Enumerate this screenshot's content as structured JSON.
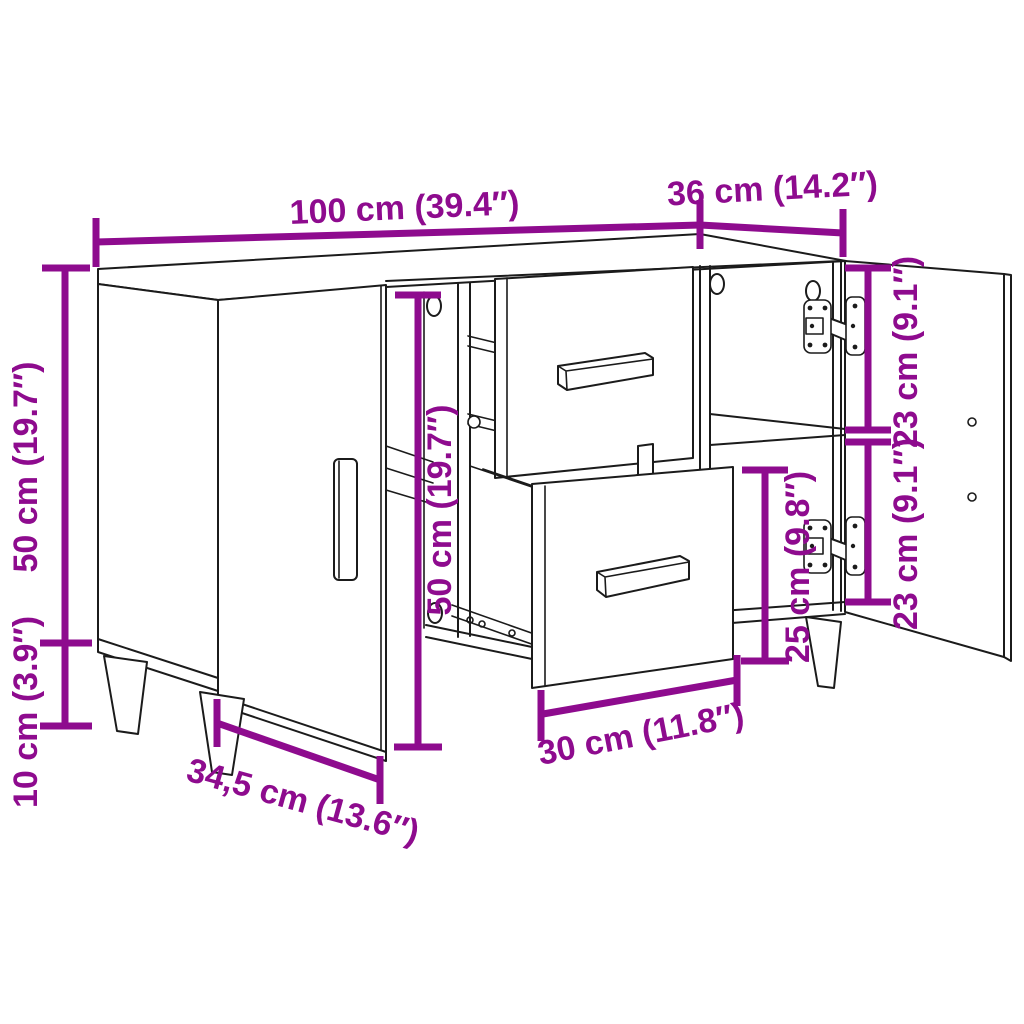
{
  "diagram": {
    "subject": "sideboard-dimension-drawing",
    "colors": {
      "dimension_annotation": "#8E0B8E",
      "line_art": "#1B1B1B",
      "background": "#FFFFFF"
    },
    "dimensions": {
      "width": {
        "label": "100 cm (39.4″)"
      },
      "depth": {
        "label": "36 cm (14.2″)"
      },
      "body_height": {
        "label": "50 cm (19.7″)"
      },
      "leg_height": {
        "label": "10 cm (3.9″)"
      },
      "front_height": {
        "label": "50 cm (19.7″)"
      },
      "compartment_top": {
        "label": "23 cm (9.1″)"
      },
      "compartment_bottom": {
        "label": "23 cm (9.1″)"
      },
      "drawer_height": {
        "label": "25 cm (9.8″)"
      },
      "drawer_width": {
        "label": "30 cm (11.8″)"
      },
      "door_width": {
        "label": "34,5 cm (13.6″)"
      }
    }
  }
}
